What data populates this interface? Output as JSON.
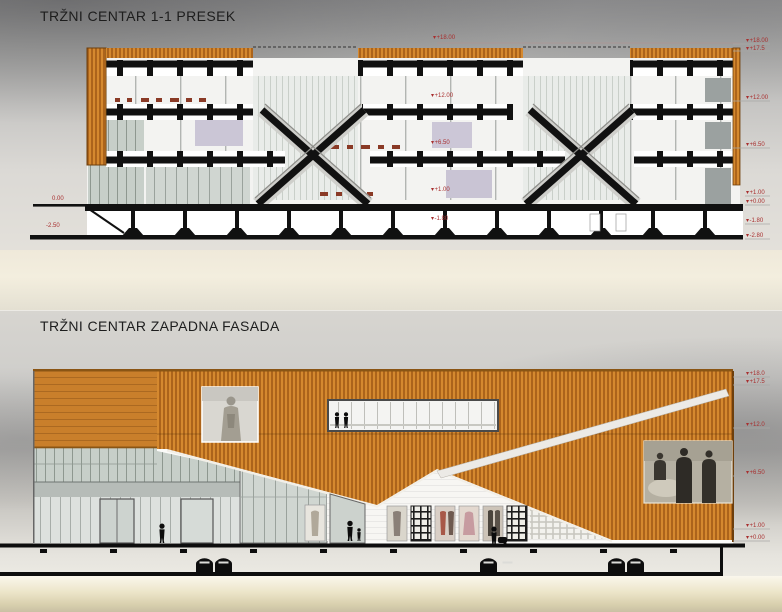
{
  "colors": {
    "facade_orange": "#c87a22",
    "orange_slat_dark": "#9a5512",
    "marker_red": "#a82f2f",
    "drawing_black": "#111111"
  },
  "section_drawing": {
    "title": "TRŽNI CENTAR 1-1 PRESEK",
    "right_levels": [
      {
        "label": "+18.00",
        "y": 41
      },
      {
        "label": "+17.5",
        "y": 49
      },
      {
        "label": "+12.00",
        "y": 98
      },
      {
        "label": "+6.50",
        "y": 145
      },
      {
        "label": "+1.00",
        "y": 193
      },
      {
        "label": "+0.00",
        "y": 202
      },
      {
        "label": "-1.80",
        "y": 221
      },
      {
        "label": "-2.80",
        "y": 236
      }
    ],
    "left_levels": [
      {
        "label": "0.00",
        "x": 52,
        "y": 199
      },
      {
        "label": "-2.50",
        "x": 46,
        "y": 226
      }
    ],
    "inline_levels": [
      {
        "label": "+18.00",
        "x": 433,
        "y": 38
      },
      {
        "label": "+12.00",
        "x": 431,
        "y": 96
      },
      {
        "label": "+6.50",
        "x": 431,
        "y": 143
      },
      {
        "label": "+1.00",
        "x": 431,
        "y": 190
      },
      {
        "label": "-1.80",
        "x": 431,
        "y": 219
      }
    ]
  },
  "facade_drawing": {
    "title": "TRŽNI CENTAR ZAPADNA FASADA",
    "right_levels": [
      {
        "label": "+18.0",
        "y": 374
      },
      {
        "label": "+17.5",
        "y": 382
      },
      {
        "label": "+12.0",
        "y": 425
      },
      {
        "label": "+6.50",
        "y": 473
      },
      {
        "label": "+1.00",
        "y": 526
      },
      {
        "label": "+0.00",
        "y": 538
      }
    ]
  }
}
